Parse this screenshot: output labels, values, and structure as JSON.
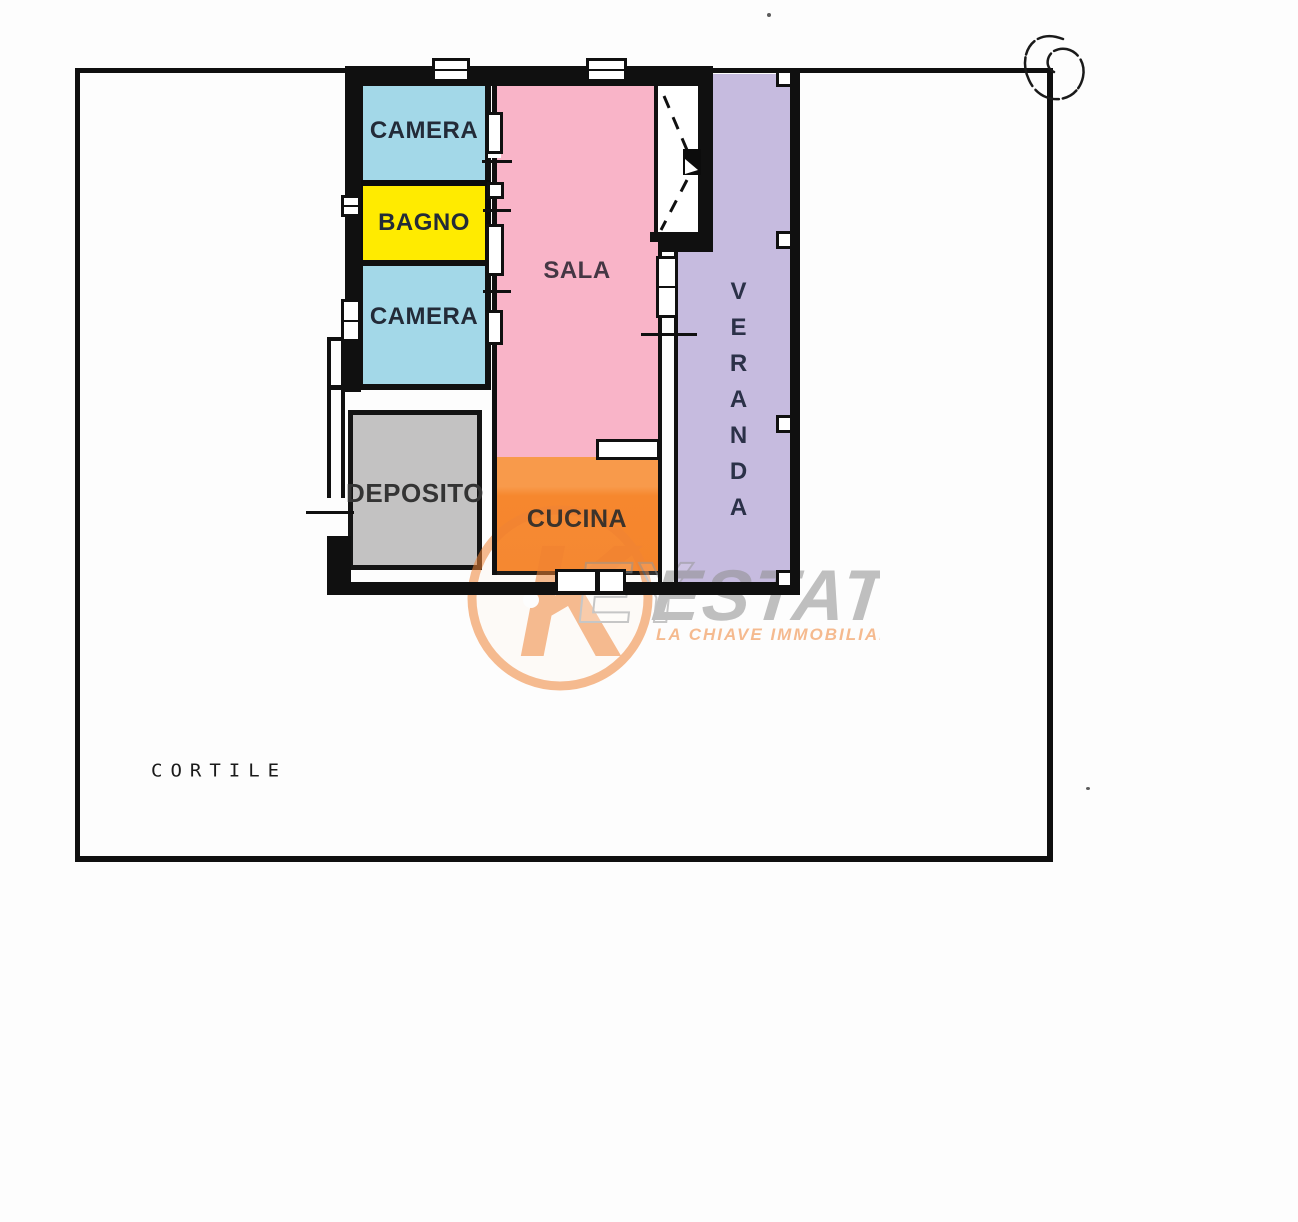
{
  "plan": {
    "rooms": {
      "camera_top": {
        "label": "CAMERA",
        "color": "#a3d8e8"
      },
      "bagno": {
        "label": "BAGNO",
        "color": "#ffeb00"
      },
      "camera_bottom": {
        "label": "CAMERA",
        "color": "#a3d8e8"
      },
      "sala": {
        "label": "SALA",
        "color": "#f9b4c8"
      },
      "cucina": {
        "label": "CUCINA",
        "color": "#f6872e"
      },
      "deposito": {
        "label": "DEPOSITO",
        "color": "#c3c2c2"
      },
      "veranda": {
        "label": "VERANDA",
        "color": "#c6bbdf"
      }
    },
    "courtyard_label": "CORTILE",
    "wall_color": "#101010"
  },
  "watermark": {
    "monogram": "K",
    "ghost": "EY",
    "brand": "ESTATE",
    "tagline": "LA CHIAVE IMMOBILIARE",
    "accent_color": "#f08436",
    "text_color": "#8e8e8e"
  }
}
